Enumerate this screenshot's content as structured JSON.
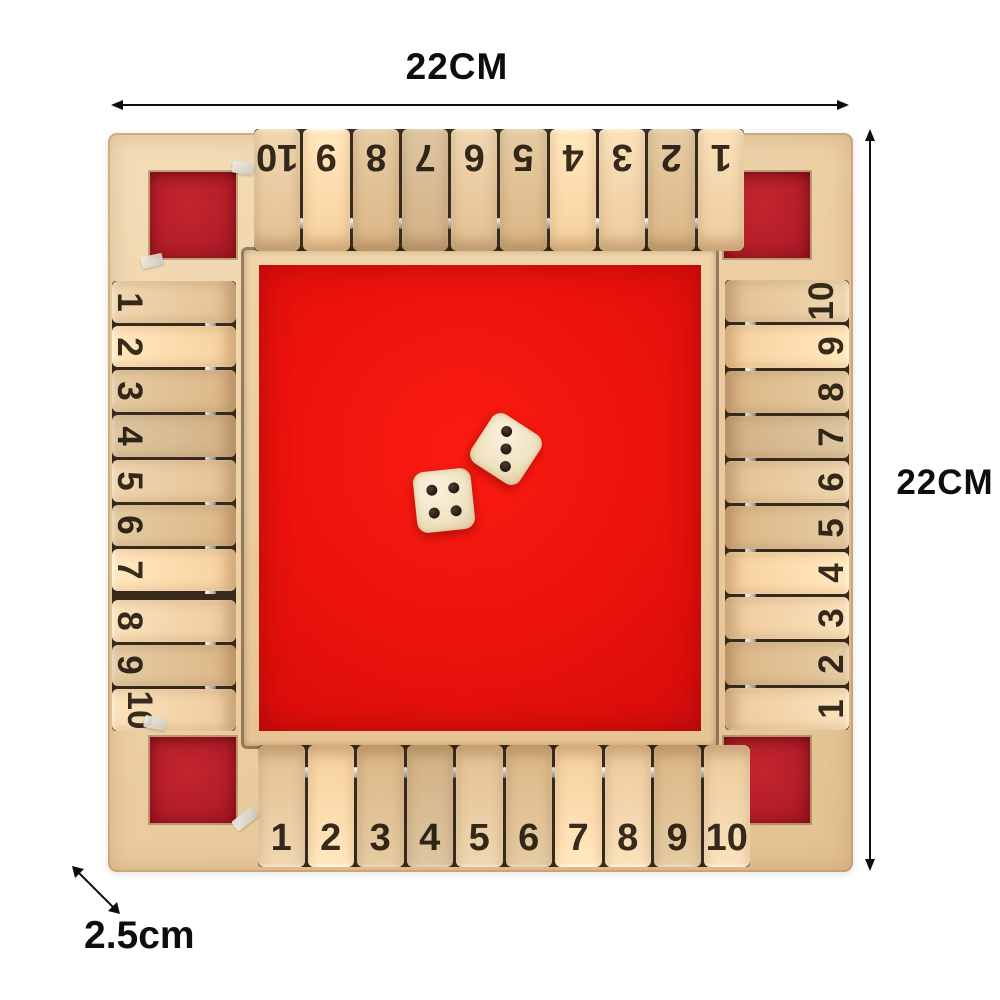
{
  "annotations": {
    "width_label": "22CM",
    "height_label": "22CM",
    "thickness_label": "2.5cm"
  },
  "board": {
    "rows": {
      "top": [
        "10",
        "9",
        "8",
        "7",
        "6",
        "5",
        "4",
        "3",
        "2",
        "1"
      ],
      "bottom": [
        "1",
        "2",
        "3",
        "4",
        "5",
        "6",
        "7",
        "8",
        "9",
        "10"
      ],
      "left": [
        "1",
        "2",
        "3",
        "4",
        "5",
        "6",
        "7",
        "8",
        "9",
        "10"
      ],
      "right": [
        "10",
        "9",
        "8",
        "7",
        "6",
        "5",
        "4",
        "3",
        "2",
        "1"
      ]
    },
    "dice": [
      {
        "id": "die-1",
        "pips": 4
      },
      {
        "id": "die-2",
        "pips": 3
      }
    ],
    "colors": {
      "felt_red": "#ee130d",
      "corner_red": "#c4252e",
      "wood_light": "#f0d7b0",
      "wood_mid": "#e3c092",
      "pip": "#23180f"
    }
  }
}
